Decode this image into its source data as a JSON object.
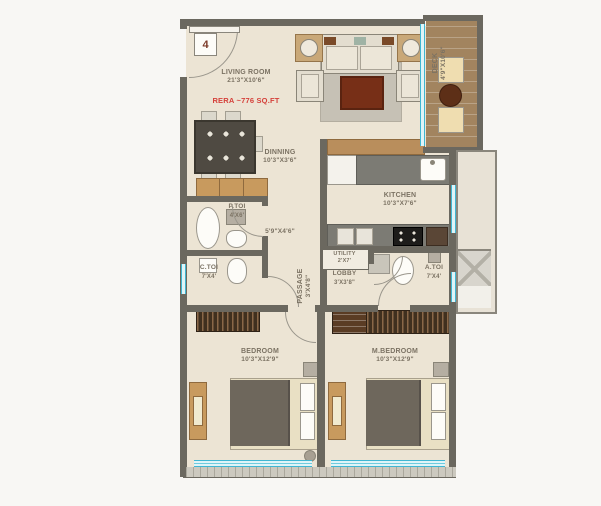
{
  "plan": {
    "unit_number": "4",
    "area_note": "RERA ~776 SQ.FT",
    "passage_dim_note": "5'9\"X4'6\"",
    "rooms": {
      "living": {
        "name": "LIVING ROOM",
        "dims": "21'3\"X10'6\""
      },
      "dining": {
        "name": "DINNING",
        "dims": "10'3\"X3'6\""
      },
      "deck": {
        "name": "DECK",
        "dims": "4'9\"X10'6\""
      },
      "kitchen": {
        "name": "KITCHEN",
        "dims": "10'3\"X7'6\""
      },
      "p_toi": {
        "name": "P.TOI",
        "dims": "4'X6'"
      },
      "passage": {
        "name": "PASSAGE",
        "dims": "3'X4'8\""
      },
      "c_toi": {
        "name": "C.TOI",
        "dims": "7'X4'"
      },
      "utility": {
        "name": "UTILITY",
        "dims": "2'X7'"
      },
      "lobby": {
        "name": "LOBBY",
        "dims": "3'X3'8\""
      },
      "a_toi": {
        "name": "A.TOI",
        "dims": "7'X4'"
      },
      "bedroom": {
        "name": "BEDROOM",
        "dims": "10'3\"X12'9\""
      },
      "m_bedroom": {
        "name": "M.BEDROOM",
        "dims": "10'3\"X12'9\""
      }
    },
    "colors": {
      "wall": "#6b685f",
      "floor": "#ece4d4",
      "deck_wood": "#a2845f",
      "glass": "#3fb6d2",
      "area_note_red": "#d5403a",
      "label_text": "#7b7263"
    }
  }
}
